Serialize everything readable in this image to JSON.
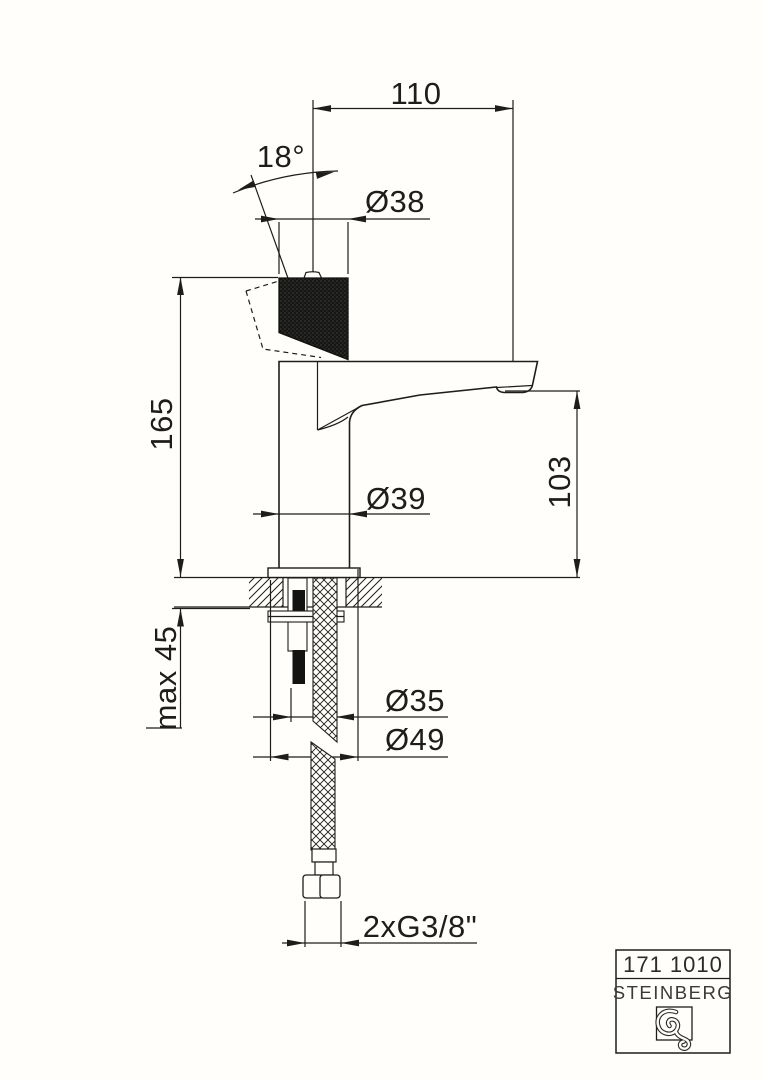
{
  "colors": {
    "background": "#fffefa",
    "line": "#1d1d1b"
  },
  "dimensions": {
    "spout_reach": "110",
    "handle_angle": "18°",
    "handle_diameter": "Ø38",
    "total_height": "165",
    "outlet_height": "103",
    "body_diameter": "Ø39",
    "max_mounting_thickness": "max 45",
    "shank_diameter": "Ø35",
    "base_diameter": "Ø49",
    "supply_connection": "2xG3/8\""
  },
  "title_block": {
    "article_number": "171 1010",
    "brand": "STEINBERG"
  }
}
